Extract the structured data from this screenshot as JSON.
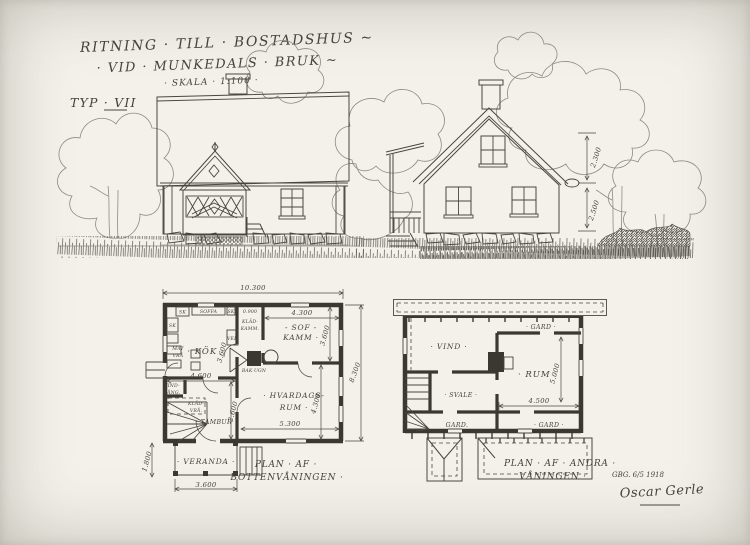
{
  "palette": {
    "paper": "#f3f1ea",
    "ink": "#45433c",
    "wall": "#3a3831",
    "faint": "#8f8a7c"
  },
  "title": {
    "line1": "RITNING · TILL · BOSTADSHUS ~",
    "line2": "· VID · MUNKEDALS · BRUK ~",
    "scale": "· SKALA · 1:100 ·",
    "typ": "TYP · VII"
  },
  "elevation_right": {
    "dim_upper": "2.300",
    "dim_lower": "2.500"
  },
  "ground_plan": {
    "caption1": "PLAN · AF ·",
    "caption2": "BOTTENVÅNINGEN ·",
    "dims": {
      "total_w": "10.300",
      "total_h": "8.300",
      "kok_w": "4.600",
      "kok_h": "3.600",
      "sof_w": "4.300",
      "sof_h": "3.600",
      "klad_w": "0.900",
      "hv_w": "5.300",
      "hv_h": "4.300",
      "tambur_h": "2.600",
      "veranda_w": "3.600",
      "veranda_h": "1.800"
    },
    "rooms": {
      "kok": "· KÖK ·",
      "sof1": "- SOF -",
      "sof2": "KAMM ·",
      "klad1": "KLÄD-",
      "klad2": "KAMM.",
      "hv1": "· HVARDAGS-",
      "hv2": "RUM ·",
      "tambur": "· TAMBUR",
      "veranda": "· VERANDA ·",
      "mat1": "MAT",
      "mat2": "VRÅ",
      "vf1": "VIND-",
      "vf2": "FÅNG.",
      "kv1": "KLÄD-",
      "kv2": "VRÅ.",
      "ved": "VED",
      "bakugn": "BAK-UGN",
      "sk1": "SK",
      "soffa": "SOFFA",
      "sk2": "SK",
      "sk3": "SK"
    }
  },
  "upper_plan": {
    "caption1": "PLAN · AF · ANDRA ·",
    "caption2": "VÅNINGEN ·",
    "dims": {
      "rum_w": "4.500",
      "rum_h": "5.000"
    },
    "rooms": {
      "vind": "· VIND ·",
      "gard_top": "· GARD ·",
      "rum": "· RUM ·",
      "svale": "· SVALE ·",
      "gard_bl": "GARD.",
      "gard_br": "· GARD ·"
    }
  },
  "signature": {
    "date": "GBG. 6/5 1918",
    "name": "Oscar Gerle"
  }
}
